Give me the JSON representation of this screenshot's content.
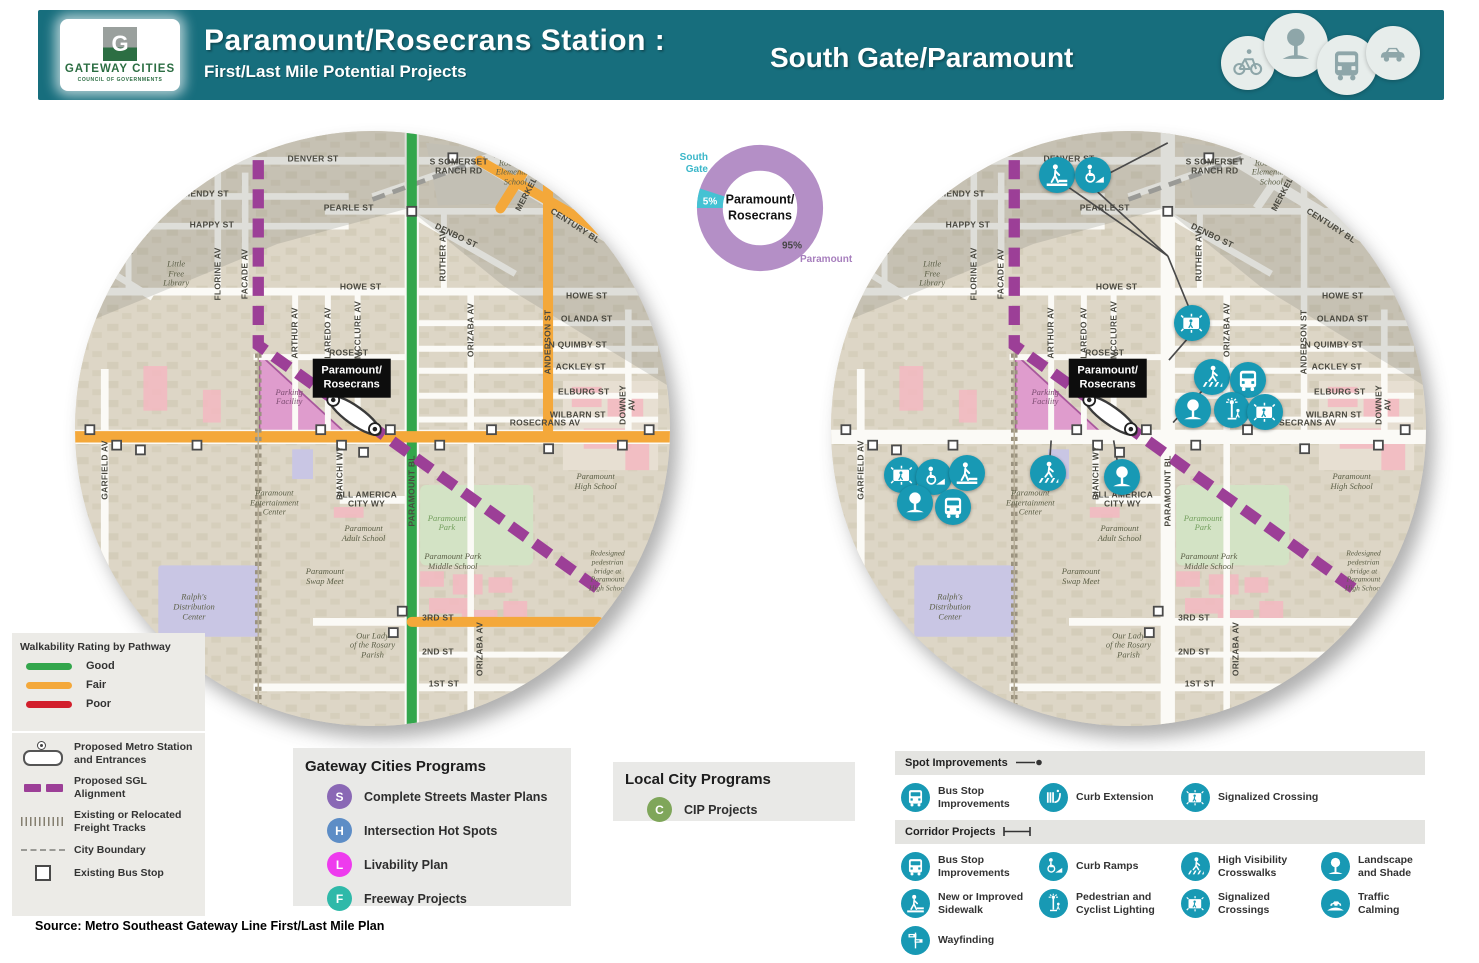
{
  "header": {
    "bg_color": "#176e7d",
    "logo": {
      "letter": "G",
      "org": "GATEWAY CITIES",
      "sub": "COUNCIL OF GOVERNMENTS"
    },
    "title": "Paramount/Rosecrans Station :",
    "subtitle": "First/Last Mile Potential Projects",
    "region": "South Gate/Paramount",
    "mode_icons": [
      "bike-icon",
      "tree-icon",
      "bus-icon",
      "car-icon"
    ]
  },
  "chart_data": {
    "type": "pie",
    "donut": true,
    "title": "Station area city share",
    "center_label": "Paramount/\nRosecrans",
    "slices": [
      {
        "label": "Paramount",
        "value": 95,
        "pct_label": "95%",
        "color": "#b48fc6"
      },
      {
        "label": "South Gate",
        "value": 5,
        "pct_label": "5%",
        "color": "#45c2d3"
      }
    ],
    "legend_position": "outside-labels"
  },
  "station": {
    "label": "Paramount/\nRosecrans"
  },
  "map_labels": [
    {
      "t": "DENVER ST",
      "x": 40,
      "y": 4.7,
      "r": 0,
      "c": "s"
    },
    {
      "t": "S SOMERSET\nRANCH RD",
      "x": 64.5,
      "y": 6,
      "r": 0,
      "c": "s"
    },
    {
      "t": "MENDY ST",
      "x": 22,
      "y": 10.6,
      "r": 0,
      "c": "s"
    },
    {
      "t": "PEARLE ST",
      "x": 46,
      "y": 13,
      "r": 0,
      "c": "s"
    },
    {
      "t": "HAPPY ST",
      "x": 23,
      "y": 15.8,
      "r": 0,
      "c": "s"
    },
    {
      "t": "CENTURY BL",
      "x": 84,
      "y": 16,
      "r": 33,
      "c": "s"
    },
    {
      "t": "MERKEL AV",
      "x": 76.5,
      "y": 9.5,
      "r": -62,
      "c": "s"
    },
    {
      "t": "DENBO ST",
      "x": 64,
      "y": 17.6,
      "r": 26,
      "c": "s"
    },
    {
      "t": "RUTHER AV",
      "x": 61.8,
      "y": 21,
      "r": -90,
      "c": "s"
    },
    {
      "t": "RACINE AV",
      "x": 6.5,
      "y": 22.5,
      "r": -38,
      "c": "s"
    },
    {
      "t": "Little\nFree\nLibrary",
      "x": 17,
      "y": 24,
      "r": 0,
      "c": "p"
    },
    {
      "t": "FLORINE AV",
      "x": 24,
      "y": 24,
      "r": -90,
      "c": "s"
    },
    {
      "t": "FACADE AV",
      "x": 28.6,
      "y": 24,
      "r": -90,
      "c": "s"
    },
    {
      "t": "HOWE ST",
      "x": 48,
      "y": 26.2,
      "r": 0,
      "c": "s"
    },
    {
      "t": "HOWE ST",
      "x": 86,
      "y": 27.8,
      "r": 0,
      "c": "s"
    },
    {
      "t": "OLANDA ST",
      "x": 86,
      "y": 31.6,
      "r": 0,
      "c": "s"
    },
    {
      "t": "N QUIMBY ST",
      "x": 84.5,
      "y": 35.9,
      "r": 0,
      "c": "s"
    },
    {
      "t": "ACKLEY ST",
      "x": 85,
      "y": 39.6,
      "r": 0,
      "c": "s"
    },
    {
      "t": "ELBURG ST",
      "x": 85.5,
      "y": 43.8,
      "r": 0,
      "c": "s"
    },
    {
      "t": "WILBARN ST",
      "x": 84.5,
      "y": 47.8,
      "r": 0,
      "c": "s"
    },
    {
      "t": "ROSE ST",
      "x": 46,
      "y": 37.3,
      "r": 0,
      "c": "s"
    },
    {
      "t": "ARTHUR AV",
      "x": 37,
      "y": 34,
      "r": -90,
      "c": "s"
    },
    {
      "t": "LAREDO AV",
      "x": 42.5,
      "y": 34,
      "r": -90,
      "c": "s"
    },
    {
      "t": "MCCLURE AV",
      "x": 47.5,
      "y": 33.5,
      "r": -90,
      "c": "s"
    },
    {
      "t": "ORIZABA AV",
      "x": 66.5,
      "y": 33.5,
      "r": -90,
      "c": "s"
    },
    {
      "t": "ANDERSON ST",
      "x": 79.5,
      "y": 35.5,
      "r": -90,
      "c": "s"
    },
    {
      "t": "DOWNEY AV",
      "x": 93,
      "y": 46,
      "r": -90,
      "c": "s"
    },
    {
      "t": "ROSECRANS AV",
      "x": 79,
      "y": 49,
      "r": 0,
      "c": "s"
    },
    {
      "t": "Roosevelt\nElementary\nSchool",
      "x": 74,
      "y": 7,
      "r": 0,
      "c": "p"
    },
    {
      "t": "Parking\nFacility",
      "x": 36,
      "y": 44.8,
      "r": 0,
      "c": "pp"
    },
    {
      "t": "GARFIELD AV",
      "x": 5,
      "y": 57,
      "r": -90,
      "c": "s"
    },
    {
      "t": "BIANCHI WY",
      "x": 44.5,
      "y": 57.5,
      "r": -90,
      "c": "s"
    },
    {
      "t": "PARAMOUNT BL",
      "x": 56.6,
      "y": 60.5,
      "r": -90,
      "c": "s"
    },
    {
      "t": "ALL AMERICA\nCITY WY",
      "x": 49,
      "y": 62,
      "r": 0,
      "c": "s"
    },
    {
      "t": "Paramount\nEntertainment\nCenter",
      "x": 33.5,
      "y": 62.5,
      "r": 0,
      "c": "p"
    },
    {
      "t": "Paramount\nAdult School",
      "x": 48.5,
      "y": 67.8,
      "r": 0,
      "c": "p"
    },
    {
      "t": "Paramount\nSwap Meet",
      "x": 42,
      "y": 75,
      "r": 0,
      "c": "p"
    },
    {
      "t": "Paramount\nPark",
      "x": 62.5,
      "y": 66,
      "r": 0,
      "c": "pg"
    },
    {
      "t": "Paramount Park\nMiddle School",
      "x": 63.5,
      "y": 72.5,
      "r": 0,
      "c": "p"
    },
    {
      "t": "Paramount\nHigh School",
      "x": 87.5,
      "y": 59,
      "r": 0,
      "c": "p"
    },
    {
      "t": "Redesigned\npedestrian\nbridge at\nParamount\nHigh School",
      "x": 89.5,
      "y": 74,
      "r": 0,
      "c": "ps"
    },
    {
      "t": "Ralph's\nDistribution\nCenter",
      "x": 20,
      "y": 80,
      "r": 0,
      "c": "p"
    },
    {
      "t": "Our Lady\nof the Rosary\nParish",
      "x": 50,
      "y": 86.5,
      "r": 0,
      "c": "p"
    },
    {
      "t": "3RD ST",
      "x": 61,
      "y": 81.8,
      "r": 0,
      "c": "s"
    },
    {
      "t": "2ND ST",
      "x": 61,
      "y": 87.5,
      "r": 0,
      "c": "s"
    },
    {
      "t": "ORIZABA AV",
      "x": 68,
      "y": 87,
      "r": -90,
      "c": "s"
    },
    {
      "t": "1ST ST",
      "x": 62,
      "y": 93,
      "r": 0,
      "c": "s"
    },
    {
      "t": "SOMERSET BL",
      "x": 16,
      "y": 92.8,
      "r": 0,
      "c": "s"
    }
  ],
  "right_map_icons": [
    {
      "icon": "sidewalk",
      "x": 38,
      "y": 7.4
    },
    {
      "icon": "curb-ramp",
      "x": 44,
      "y": 7.4
    },
    {
      "icon": "signal",
      "x": 60.7,
      "y": 32.3
    },
    {
      "icon": "crosswalk",
      "x": 64,
      "y": 41.3
    },
    {
      "icon": "bus",
      "x": 70.1,
      "y": 41.8
    },
    {
      "icon": "tree",
      "x": 60.8,
      "y": 46.9
    },
    {
      "icon": "lighting",
      "x": 67.4,
      "y": 46.9
    },
    {
      "icon": "signal",
      "x": 72.9,
      "y": 47.2
    },
    {
      "icon": "signal",
      "x": 11.9,
      "y": 57.8
    },
    {
      "icon": "curb-ramp",
      "x": 17.3,
      "y": 58.2
    },
    {
      "icon": "sidewalk",
      "x": 22.9,
      "y": 57.5
    },
    {
      "icon": "tree",
      "x": 14.1,
      "y": 62.5
    },
    {
      "icon": "bus",
      "x": 20.5,
      "y": 63.2
    },
    {
      "icon": "crosswalk",
      "x": 36.5,
      "y": 57.5
    },
    {
      "icon": "tree",
      "x": 48.9,
      "y": 58.2
    }
  ],
  "walkability_legend": {
    "title": "Walkability Rating by Pathway",
    "items": [
      {
        "label": "Good",
        "color": "#33a64c"
      },
      {
        "label": "Fair",
        "color": "#f4a83a"
      },
      {
        "label": "Poor",
        "color": "#d21f2c"
      }
    ]
  },
  "symbols_legend": {
    "items": [
      {
        "icon": "metro-station-icon",
        "label": "Proposed Metro Station\nand Entrances"
      },
      {
        "icon": "sgl-alignment-icon",
        "label": "Proposed SGL\nAlignment",
        "color": "#9c3f97"
      },
      {
        "icon": "freight-tracks-icon",
        "label": "Existing or Relocated\nFreight Tracks"
      },
      {
        "icon": "city-boundary-icon",
        "label": "City Boundary"
      },
      {
        "icon": "bus-stop-icon",
        "label": "Existing Bus Stop"
      }
    ]
  },
  "gateway_programs": {
    "title": "Gateway Cities Programs",
    "items": [
      {
        "letter": "S",
        "color": "#8a68b5",
        "label": "Complete Streets Master Plans"
      },
      {
        "letter": "H",
        "color": "#5d8dc6",
        "label": "Intersection Hot Spots"
      },
      {
        "letter": "L",
        "color": "#ee3bee",
        "label": "Livability Plan"
      },
      {
        "letter": "F",
        "color": "#2fb9a9",
        "label": "Freeway Projects"
      }
    ]
  },
  "local_programs": {
    "title": "Local City Programs",
    "items": [
      {
        "letter": "C",
        "color": "#7fa65a",
        "label": "CIP Projects"
      }
    ]
  },
  "projects_legend": {
    "icon_color": "#1899b4",
    "sections": [
      {
        "title": "Spot Improvements",
        "marker": "spot",
        "items": [
          {
            "icon": "bus",
            "label": "Bus Stop Improvements"
          },
          {
            "icon": "curb-extension",
            "label": "Curb Extension"
          },
          {
            "icon": "signal",
            "label": "Signalized Crossing"
          }
        ]
      },
      {
        "title": "Corridor Projects",
        "marker": "corridor",
        "items": [
          {
            "icon": "bus",
            "label": "Bus Stop Improvements"
          },
          {
            "icon": "curb-ramp",
            "label": "Curb Ramps"
          },
          {
            "icon": "crosswalk",
            "label": "High Visibility Crosswalks"
          },
          {
            "icon": "tree",
            "label": "Landscape and Shade"
          },
          {
            "icon": "sidewalk",
            "label": "New or Improved Sidewalk"
          },
          {
            "icon": "lighting",
            "label": "Pedestrian and Cyclist Lighting"
          },
          {
            "icon": "signal",
            "label": "Signalized Crossings"
          },
          {
            "icon": "traffic-calming",
            "label": "Traffic Calming"
          },
          {
            "icon": "wayfinding",
            "label": "Wayfinding"
          }
        ]
      }
    ]
  },
  "source": "Source: Metro Southeast Gateway Line First/Last Mile Plan"
}
